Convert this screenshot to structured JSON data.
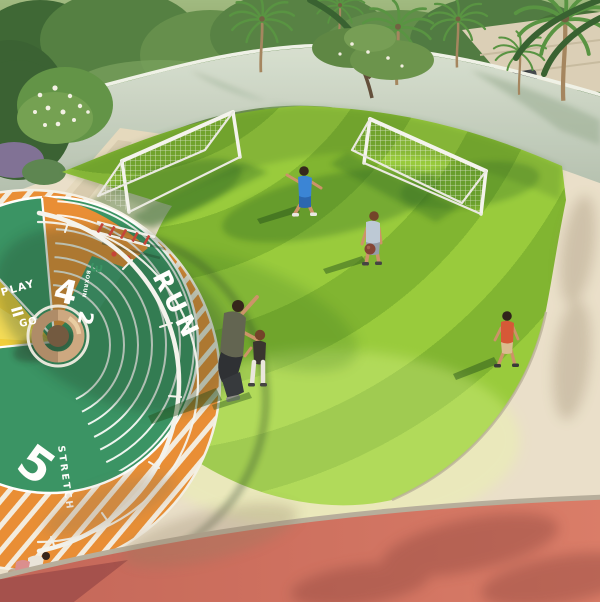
{
  "scene": {
    "type": "aerial-architectural-render",
    "description": "Sunny aerial view of a children's rooftop play area: a circular striped lawn used as a football field with two white goals, bordered by a colourful rubber running/play track on the left, a curved light wall with palm trees behind, beige pavement and a red running track in the foreground",
    "lighting": "bright sunlight from the right casting long shadows to the lower-left"
  },
  "track_markings": {
    "run_label": "RUN",
    "play_label": "PLAY",
    "go_label": "GO",
    "stretch_label": "STRETCH",
    "logo_text": "BOXRUN",
    "lane_5": "5",
    "lane_4": "4",
    "lane_3": "3",
    "lane_2": "2"
  },
  "people": [
    {
      "id": "boy-blue",
      "description": "boy running in blue t-shirt and blue shorts on the lawn"
    },
    {
      "id": "boy-ball",
      "description": "boy in light grey t-shirt crouching and holding a ball"
    },
    {
      "id": "adult-pointing",
      "description": "adult crouching beside a toddler, arm raised pointing"
    },
    {
      "id": "toddler",
      "description": "toddler in dark top and white trousers next to the adult"
    },
    {
      "id": "child-orange",
      "description": "child in orange t-shirt and beige shorts walking at the lawn edge"
    },
    {
      "id": "child-corner",
      "description": "small child playing on the orange track in the bottom-left corner"
    }
  ],
  "objects": [
    {
      "id": "goal-left",
      "description": "white football goal with net, upper left of lawn"
    },
    {
      "id": "goal-right",
      "description": "white football goal with net, upper right of lawn"
    },
    {
      "id": "ring-climber",
      "description": "tan circular climbing ring toy at centre of play track"
    },
    {
      "id": "monkey-bars",
      "description": "white frame with red rungs on orange sector"
    },
    {
      "id": "canopy-arc",
      "description": "large white curved rail sweeping across the play track"
    },
    {
      "id": "boundary-wall",
      "description": "curved light green-grey perimeter wall"
    },
    {
      "id": "parking-car",
      "description": "dark car parked beyond the wall, top right"
    },
    {
      "id": "palm-trees",
      "description": "row of palm trees behind the wall"
    }
  ],
  "colors": {
    "lawn_light": "#9ccf3a",
    "lawn_dark": "#7fb52a",
    "rubber_green": "#2f8f5e",
    "rubber_orange": "#e8892c",
    "rubber_yellow": "#f1cd32",
    "marking_white": "#ffffff",
    "pavement": "#e9dfc9",
    "red_track": "#d2685a",
    "red_track_dark": "#9c4642",
    "wall": "#c7d1c1",
    "ring_toy_tan": "#caa47c"
  }
}
